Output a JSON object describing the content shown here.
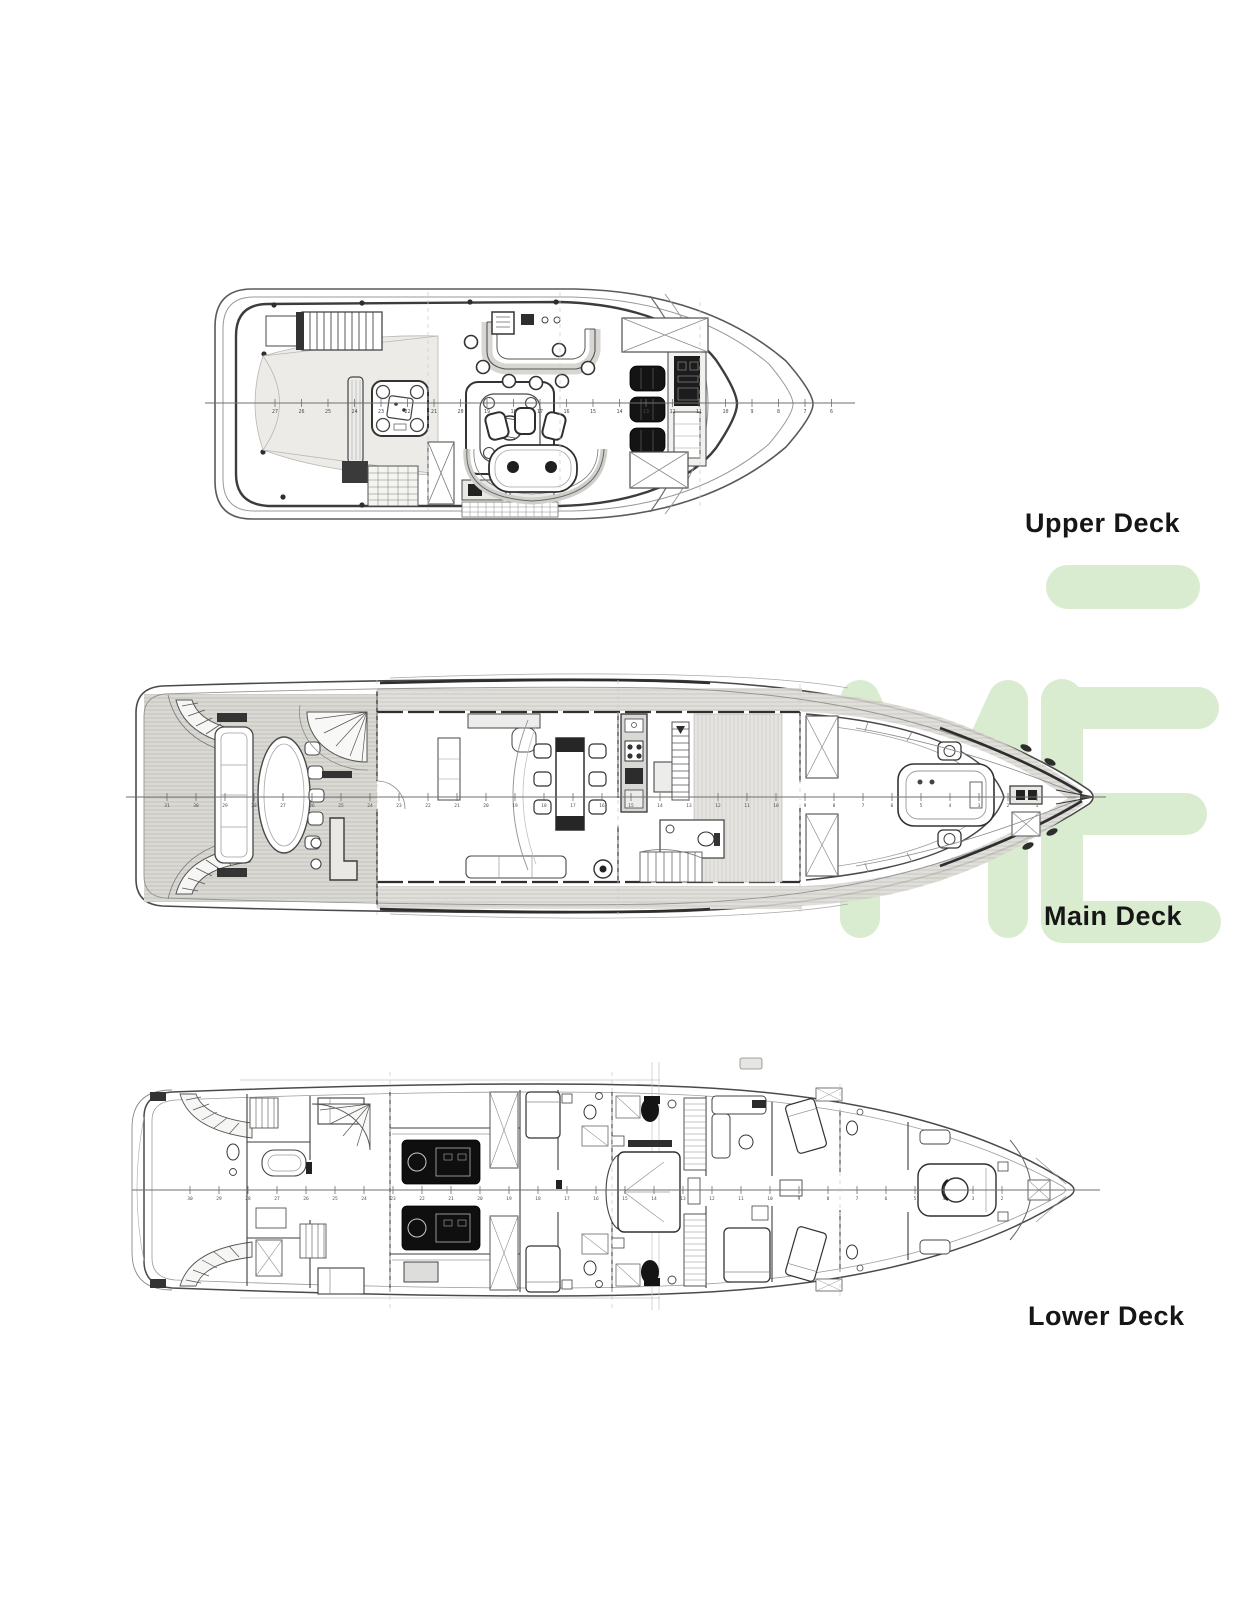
{
  "document": {
    "type": "yacht deck plan drawing",
    "background": "#ffffff"
  },
  "decks": [
    {
      "id": "upper-deck",
      "label": "Upper Deck",
      "stations": [
        27,
        26,
        25,
        24,
        23,
        22,
        21,
        20,
        19,
        18,
        17,
        16,
        15,
        14,
        13,
        12,
        11,
        10,
        9,
        8,
        7,
        6
      ]
    },
    {
      "id": "main-deck",
      "label": "Main Deck",
      "stations": [
        31,
        30,
        29,
        28,
        27,
        26,
        25,
        24,
        23,
        22,
        21,
        20,
        19,
        18,
        17,
        16,
        15,
        14,
        13,
        12,
        11,
        10,
        9,
        8,
        7,
        6,
        5,
        4,
        3,
        2,
        1
      ]
    },
    {
      "id": "lower-deck",
      "label": "Lower Deck",
      "stations": [
        30,
        29,
        28,
        27,
        26,
        25,
        24,
        23,
        22,
        21,
        20,
        19,
        18,
        17,
        16,
        15,
        14,
        13,
        12,
        11,
        10,
        9,
        8,
        7,
        6,
        5,
        4,
        3,
        2
      ]
    }
  ],
  "watermark": {
    "letters": "ME",
    "color": "#d9ecd0"
  },
  "colors": {
    "ink": "#3d3d3d",
    "light_ink": "#9a9a9a",
    "dark_fill": "#141414",
    "deck_wood": "#dbd9d4",
    "label_text": "#161616",
    "watermark_green": "#d9ecd0"
  }
}
